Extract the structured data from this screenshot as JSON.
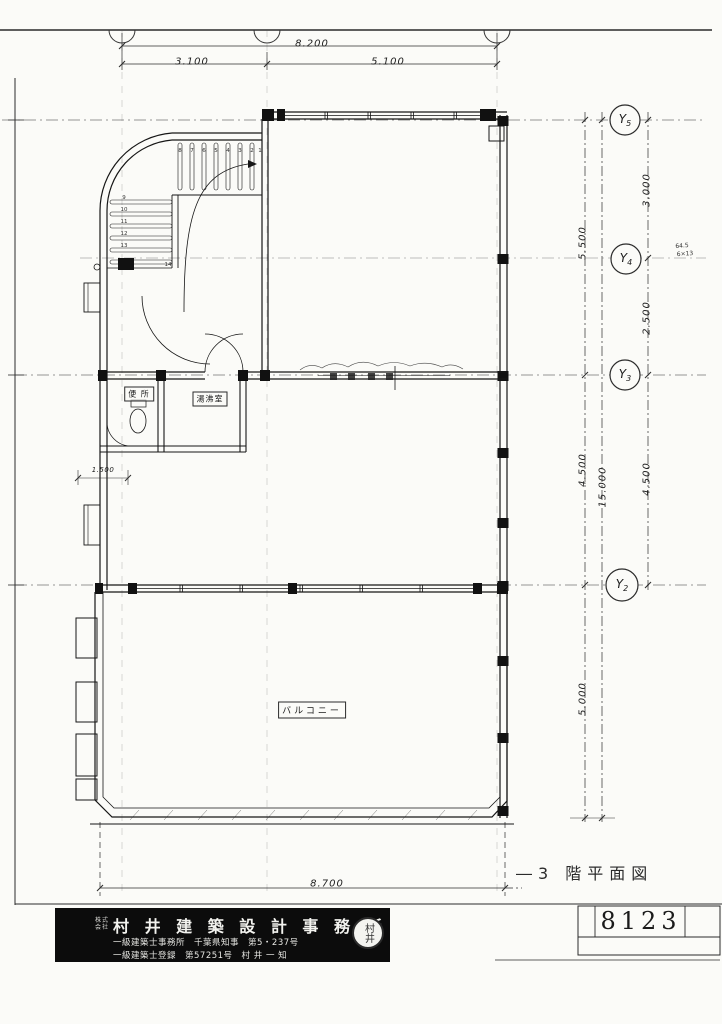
{
  "sheet": {
    "drawing_title": "―3 階平面図",
    "sheet_number": "8123",
    "stamp_text": "村井"
  },
  "title_block": {
    "prefix_line1": "株式",
    "prefix_line2": "会社",
    "office_name": "村 井 建 築 設 計 事 務 所",
    "license_line1": "一級建築士事務所　千葉県知事　第5・237号",
    "license_line2": "一級建築士登録　第57251号　村 井 一 知"
  },
  "grid_labels": {
    "y5": {
      "main": "Y",
      "sub": "5"
    },
    "y4": {
      "main": "Y",
      "sub": "4"
    },
    "y3": {
      "main": "Y",
      "sub": "3"
    },
    "y2": {
      "main": "Y",
      "sub": "2"
    }
  },
  "dimensions": {
    "top_overall": "8.200",
    "top_left": "3.100",
    "top_right": "5.100",
    "right_outer_y5_y4": "3.000",
    "right_outer_y4_y3": "2.500",
    "right_outer_y3_y2": "4.500",
    "right_mid_y5_y3": "5.500",
    "right_mid_y3_y2": "4.500",
    "right_mid_below_y2": "5.000",
    "right_overall": "15.000",
    "left_small": "1.500",
    "bottom_overall": "8.700",
    "note_line1": "64.5",
    "note_line2": "6×13"
  },
  "room_labels": {
    "toilet": "便 所",
    "kitchenette": "湯沸室",
    "balcony": "バルコニー"
  },
  "stair": {
    "upper_numbers": [
      "8",
      "7",
      "6",
      "5",
      "4",
      "3",
      "2",
      "1"
    ],
    "lower_numbers": [
      "9",
      "10",
      "11",
      "12",
      "13",
      "14"
    ]
  }
}
